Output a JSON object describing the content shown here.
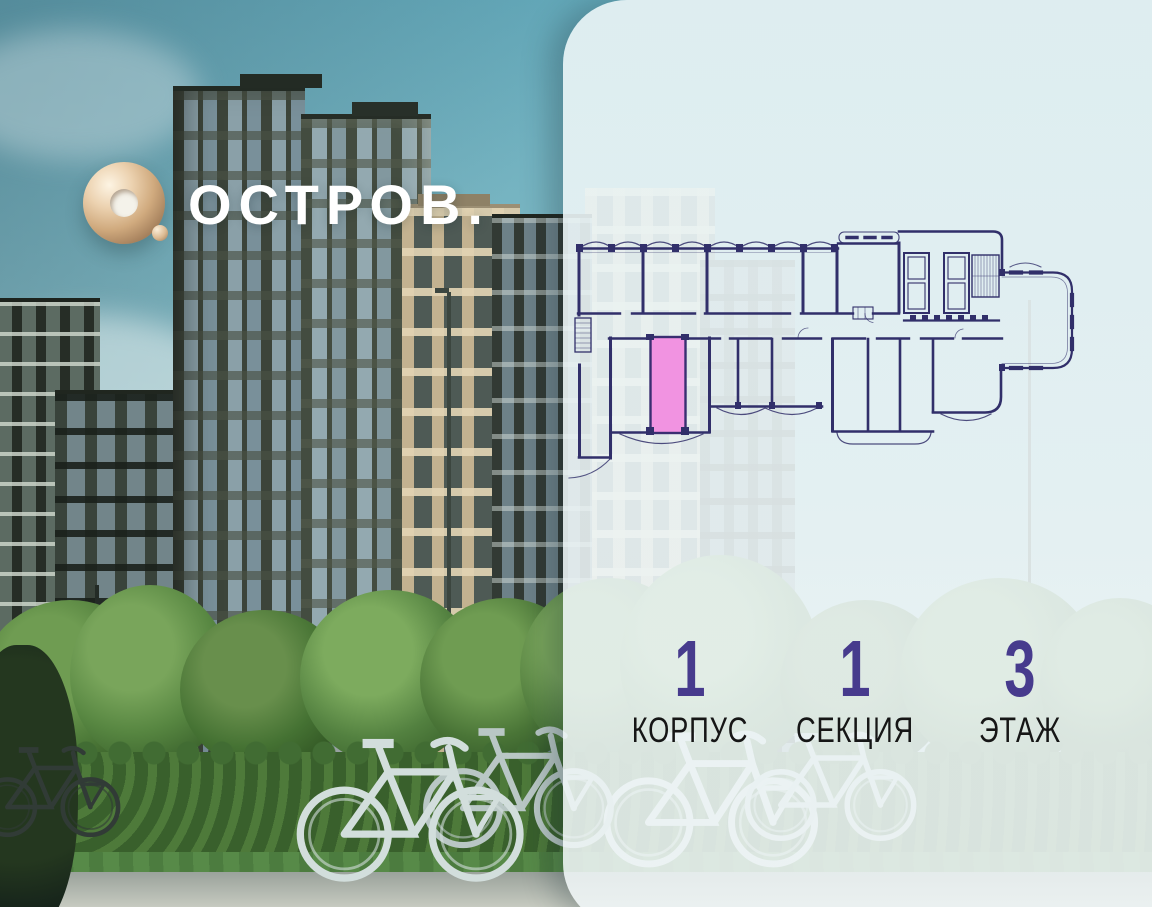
{
  "brand": {
    "logo_text": "ОСТРОВ.",
    "logo_mark": "gold-ring-o-icon"
  },
  "unit_selector": {
    "stats": [
      {
        "value": "1",
        "label": "КОРПУС"
      },
      {
        "value": "1",
        "label": "СЕКЦИЯ"
      },
      {
        "value": "3",
        "label": "ЭТАЖ"
      }
    ]
  },
  "floor_plan": {
    "highlighted_unit_fill": "#f193e1",
    "wall_color": "#312f6a"
  },
  "colors": {
    "stat_number_purple": "#473b8d",
    "stat_label_black": "#161616",
    "panel_background": "#edf4f5",
    "sky_teal": "#7db8c4",
    "logo_gold": "#d0aa7e"
  }
}
